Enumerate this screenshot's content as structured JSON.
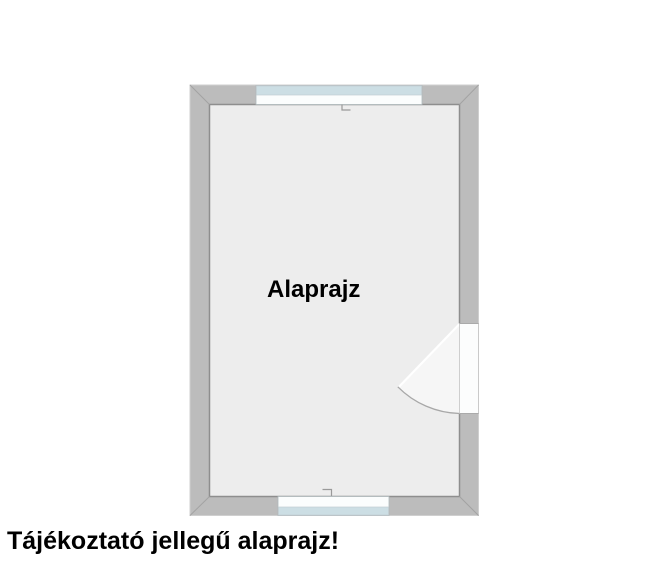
{
  "floor_plan": {
    "room_label": "Alaprajz",
    "disclaimer": "Tájékoztató jellegű alaprajz!",
    "features": {
      "top_window": "window in top wall",
      "bottom_window": "window in bottom wall",
      "door": "door in right wall opening into room"
    },
    "colors": {
      "background": "#ffffff",
      "wall_fill": "#bcbcbc",
      "wall_outer_edge": "#cfcfcf",
      "wall_inner_edge": "#8e8e8e",
      "miter_line": "#a3a3a3",
      "floor_fill": "#ededed",
      "window_frame": "#fbfdfd",
      "window_frame_edge": "#b0b9bc",
      "window_glass": "#ccdee4",
      "window_glass_edge": "#c2ced2",
      "door_opening_fill": "#fcfdfd",
      "door_opening_edge": "#c4c4c4",
      "door_swing_fill": "#f6f6f6",
      "door_leaf": "#ffffff",
      "door_arc": "#a8a8a8",
      "center_mark": "#9a9a9a",
      "text": "#000000"
    }
  }
}
